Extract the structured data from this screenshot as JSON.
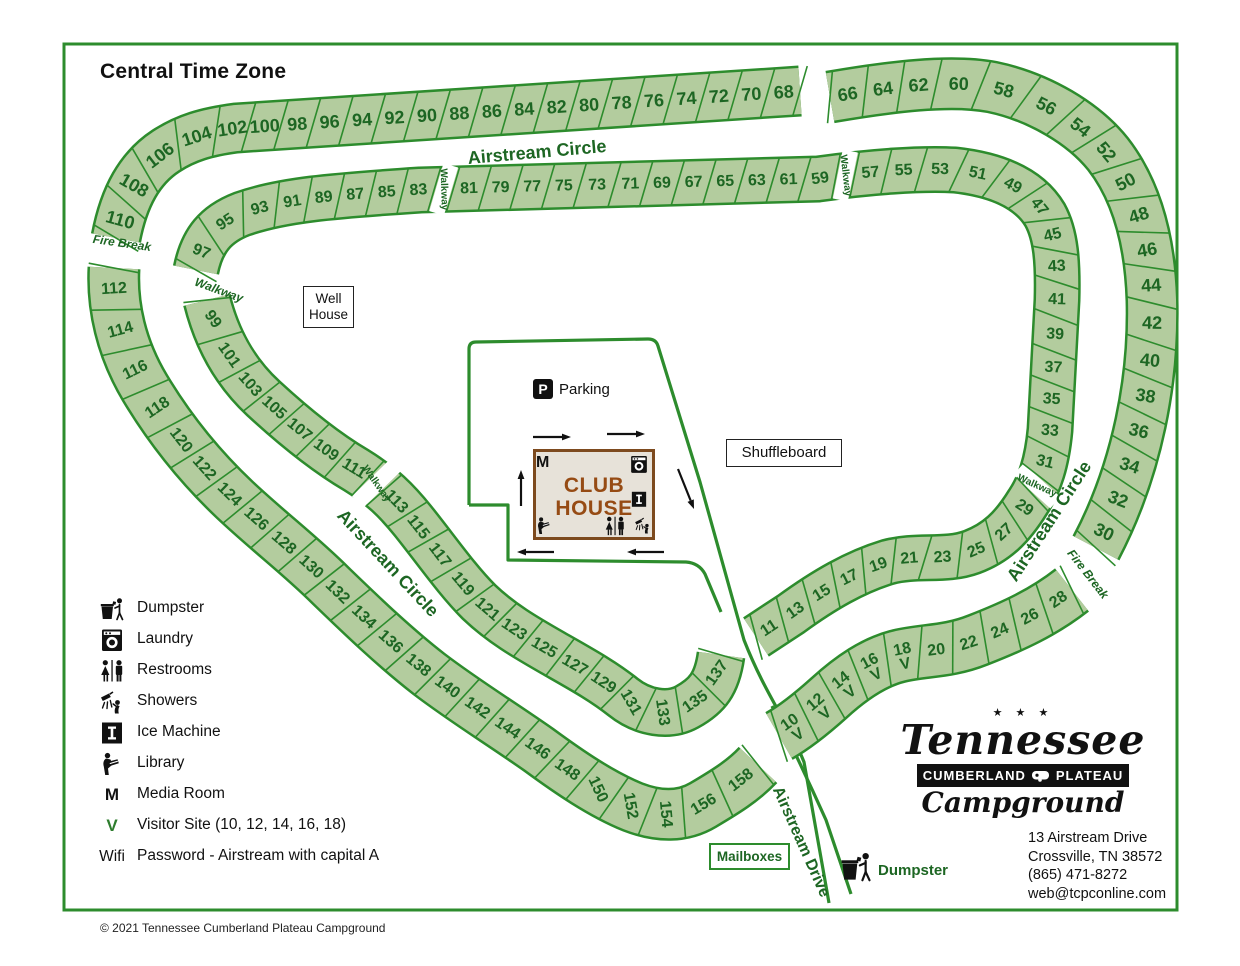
{
  "title": "Central Time Zone",
  "copyright": "© 2021 Tennessee Cumberland Plateau Campground",
  "colors": {
    "site_fill": "#b3cc9e",
    "site_border": "#2d8c2d",
    "site_text": "#1d6623",
    "road_label": "#1d6623",
    "map_border": "#2d8c2d",
    "black": "#111111",
    "visitor_green": "#2e7d2e"
  },
  "legend": {
    "items": [
      {
        "icon": "dumpster",
        "label": "Dumpster"
      },
      {
        "icon": "laundry",
        "label": "Laundry"
      },
      {
        "icon": "restrooms",
        "label": "Restrooms"
      },
      {
        "icon": "showers",
        "label": "Showers"
      },
      {
        "icon": "ice-machine",
        "label": "Ice Machine"
      },
      {
        "icon": "library",
        "label": "Library"
      },
      {
        "icon": "letter-m",
        "letter": "M",
        "label": "Media Room"
      },
      {
        "icon": "letter-v",
        "letter": "V",
        "label": "Visitor Site (10, 12, 14, 16, 18)"
      },
      {
        "icon": "text-wifi",
        "letter": "Wifi",
        "label": "Password - Airstream with capital A"
      }
    ]
  },
  "logo": {
    "stars": "★ ★ ★",
    "name": "Tennessee",
    "banner_left": "CUMBERLAND",
    "banner_right": "PLATEAU",
    "sub": "Campground"
  },
  "address": {
    "lines": [
      "13 Airstream Drive",
      "Crossville, TN 38572",
      "(865) 471-8272",
      "web@tcpconline.com"
    ]
  },
  "boxes": {
    "well_house_line1": "Well",
    "well_house_line2": "House",
    "shuffleboard": "Shuffleboard",
    "mailboxes": "Mailboxes"
  },
  "parking": {
    "icon": "P",
    "label": "Parking"
  },
  "club_house": {
    "line1": "CLUB",
    "line2": "HOUSE",
    "icons": [
      {
        "type": "letter-m",
        "letter": "M",
        "x": 544,
        "y": 464,
        "s": 16
      },
      {
        "type": "laundry",
        "x": 639,
        "y": 465,
        "s": 22
      },
      {
        "type": "ice-machine",
        "x": 639,
        "y": 500,
        "s": 20
      },
      {
        "type": "library",
        "x": 544,
        "y": 526,
        "s": 21
      },
      {
        "type": "restrooms",
        "x": 615,
        "y": 527,
        "s": 24
      },
      {
        "type": "showers",
        "x": 643,
        "y": 526,
        "s": 20
      }
    ]
  },
  "site_dumpster": {
    "label": "Dumpster",
    "icon_x": 838,
    "icon_y": 850,
    "icon_s": 36,
    "label_x": 878,
    "label_y": 862
  },
  "map": {
    "border": {
      "x": 64,
      "y": 44,
      "w": 1113,
      "h": 866
    },
    "bands": [
      {
        "name": "band-outer-top",
        "width": 46,
        "font": 18,
        "skew": 20,
        "relax": true,
        "path": "M 116 238 C 124 196 140 168 166 151 C 186 138 206 132 236 128 L 800 91",
        "sites": [
          "110#1.15",
          "108#1.15",
          "106#1.3",
          "104#1.25",
          "102",
          "100",
          "98",
          "96",
          "94",
          "92",
          "90",
          "88",
          "86",
          "84",
          "82",
          "80",
          "78",
          "76",
          "74",
          "72",
          "70",
          "68"
        ]
      },
      {
        "name": "band-outer-right",
        "width": 48,
        "font": 18,
        "skew": 15,
        "relax": true,
        "path": "M 830 97 C 888 87 950 79 992 87 C 1040 97 1084 124 1108 154 C 1136 190 1150 240 1152 300 C 1154 378 1138 468 1096 548",
        "sites": [
          "66",
          "64",
          "62",
          "60#1.25",
          "58#1.3",
          "56#1.25",
          "54",
          "52",
          "50",
          "48",
          "46",
          "44",
          "42#1.1",
          "40",
          "38",
          "36",
          "34",
          "32",
          "30"
        ]
      },
      {
        "name": "band-inner-loop",
        "width": 42,
        "font": 16,
        "skew": 18,
        "relax": true,
        "path": "M 196 270 C 202 240 216 224 242 214 C 282 200 330 196 420 190 L 818 179 C 868 172 920 168 955 170 C 1000 175 1030 190 1045 215 C 1056 235 1058 262 1057 300 L 1050 430 C 1047 462 1040 484 1028 502 C 1012 528 996 543 972 552 C 945 562 918 554 888 562 C 855 572 824 590 791 614 L 756 637",
        "sites": [
          "97#1.2",
          "95#1.25",
          "93#1.1",
          "91",
          "89",
          "87",
          "85",
          "83",
          "W#0.6",
          "81",
          "79",
          "77",
          "75",
          "73#1.1",
          "71",
          "69",
          "67",
          "65",
          "63",
          "61",
          "59",
          "W#0.6",
          "57",
          "55#1.1",
          "53#1.2",
          "51#1.2",
          "49#1.15",
          "47",
          "45",
          "43",
          "41#1.1",
          "39#1.1",
          "37",
          "35",
          "33",
          "31",
          "W#0.6",
          "29",
          "27",
          "25#1.1",
          "23#1.1",
          "21",
          "19",
          "17",
          "15",
          "13",
          "11"
        ]
      },
      {
        "name": "band-outer-left",
        "width": 48,
        "font": 16,
        "skew": 8,
        "relax": true,
        "path": "M 114 268 C 112 306 121 348 145 388 C 169 428 199 466 235 500 C 269 532 301 556 331 586 C 359 613 393 646 429 674 C 463 700 499 722 539 750 C 569 772 601 794 633 807 C 659 817 683 817 703 805 C 725 792 743 781 758 765",
        "sites": [
          "112#1.15",
          "114#1.15",
          "116#1.2",
          "118#1.2",
          "120",
          "122",
          "124",
          "126",
          "128",
          "130",
          "132",
          "134",
          "136",
          "138",
          "140",
          "142",
          "144",
          "146",
          "148",
          "150@65",
          "152@80",
          "154@85",
          "156#1.2",
          "158#1.25"
        ]
      },
      {
        "name": "band-inner-left",
        "width": 44,
        "font": 16,
        "skew": 8,
        "maxRot": 55,
        "path": "M 207 300 C 217 340 235 372 263 398 C 289 422 322 450 356 470 C 382 486 397 501 413 521 C 437 551 457 580 479 602 C 501 623 525 637 553 653 C 581 669 603 681 623 697 C 643 713 669 717 687 707 C 707 696 717 684 721 655",
        "sites": [
          "99#1.2",
          "101#1.15",
          "103",
          "105",
          "107",
          "109",
          "111",
          "W@55#0.6",
          "113",
          "115",
          "117#1.1",
          "119#1.1",
          "121",
          "123",
          "125#1.1",
          "127",
          "129",
          "131@60",
          "133@82",
          "135#1.1",
          "137#1.1"
        ]
      },
      {
        "name": "band-outer-bottom-right",
        "width": 50,
        "font": 16,
        "skew": 12,
        "relax": true,
        "path": "M 1072 590 C 1044 612 1014 626 978 640 C 948 652 924 650 899 656 C 874 662 851 678 829 698 C 809 716 793 728 779 736",
        "sites": [
          "28",
          "26",
          "24",
          "22",
          "20",
          "18V",
          "16V",
          "14V",
          "12V",
          "10V"
        ]
      }
    ],
    "roads": [
      {
        "name": "parking-outline",
        "d": "M 469 505 L 469 349 Q 469 342 476 342 L 648 339 Q 656 339 658 346 L 700 482 L 744 640 C 766 696 788 722 804 762 L 829 903"
      },
      {
        "name": "parking-step",
        "d": "M 469 505 L 508 505 L 508 560 L 686 562 Q 699 563 705 574 L 721 612"
      },
      {
        "name": "drive-right-edge",
        "d": "M 772 706 C 790 742 808 780 826 820 L 851 894"
      }
    ],
    "road_labels": [
      {
        "name": "airstream-circle-top",
        "text": "Airstream Circle",
        "x": 537,
        "y": 152,
        "rot": -5,
        "size": 18,
        "bold": true
      },
      {
        "name": "airstream-circle-left",
        "text": "Airstream Circle",
        "x": 388,
        "y": 563,
        "rot": 47,
        "size": 18,
        "bold": true
      },
      {
        "name": "airstream-circle-right",
        "text": "Airstream Circle",
        "x": 1049,
        "y": 521,
        "rot": -57,
        "size": 18,
        "bold": true
      },
      {
        "name": "airstream-drive",
        "text": "Airstream Drive",
        "x": 801,
        "y": 842,
        "rot": 66,
        "size": 16,
        "bold": true
      },
      {
        "name": "fire-break-left",
        "text": "Fire Break",
        "x": 122,
        "y": 243,
        "rot": 8,
        "size": 12,
        "bold": true,
        "italic": true
      },
      {
        "name": "fire-break-right",
        "text": "Fire Break",
        "x": 1088,
        "y": 574,
        "rot": 52,
        "size": 12,
        "bold": true,
        "italic": true
      },
      {
        "name": "walkway-gap-label",
        "text": "Walkway",
        "x": 219,
        "y": 290,
        "rot": 20,
        "size": 12,
        "bold": true,
        "italic": true
      }
    ],
    "arrows": [
      {
        "x1": 533,
        "y1": 437,
        "x2": 571,
        "y2": 437
      },
      {
        "x1": 607,
        "y1": 434,
        "x2": 645,
        "y2": 434
      },
      {
        "x1": 521,
        "y1": 506,
        "x2": 521,
        "y2": 470
      },
      {
        "x1": 678,
        "y1": 469,
        "x2": 694,
        "y2": 509
      },
      {
        "x1": 554,
        "y1": 552,
        "x2": 517,
        "y2": 552
      },
      {
        "x1": 664,
        "y1": 552,
        "x2": 627,
        "y2": 552
      }
    ],
    "walkway_text": "Walkway"
  }
}
